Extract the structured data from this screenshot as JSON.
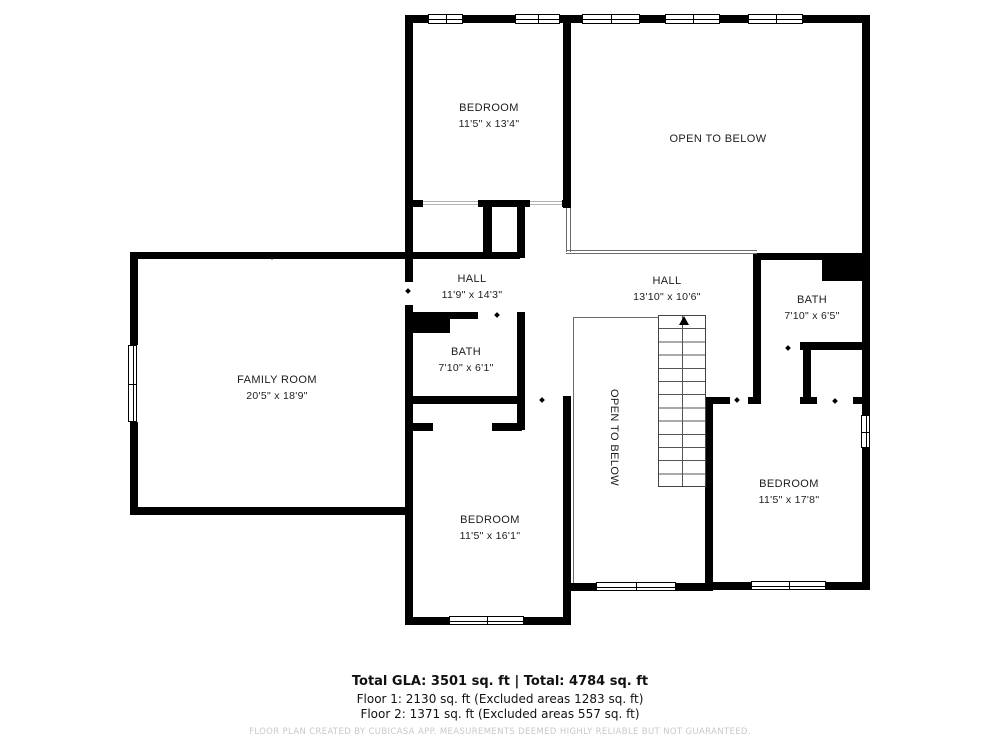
{
  "rooms": [
    {
      "id": "bedroom-top",
      "name": "BEDROOM",
      "dims": "11'5\" x 13'4\""
    },
    {
      "id": "open-below-top",
      "name": "OPEN TO BELOW",
      "dims": ""
    },
    {
      "id": "hall-left",
      "name": "HALL",
      "dims": "11'9\" x 14'3\""
    },
    {
      "id": "hall-right",
      "name": "HALL",
      "dims": "13'10\" x 10'6\""
    },
    {
      "id": "bath-right",
      "name": "BATH",
      "dims": "7'10\" x 6'5\""
    },
    {
      "id": "family-room",
      "name": "FAMILY ROOM",
      "dims": "20'5\" x 18'9\""
    },
    {
      "id": "bath-middle",
      "name": "BATH",
      "dims": "7'10\" x 6'1\""
    },
    {
      "id": "open-below-stairs",
      "name": "OPEN TO BELOW",
      "dims": ""
    },
    {
      "id": "bedroom-right",
      "name": "BEDROOM",
      "dims": "11'5\" x 17'8\""
    },
    {
      "id": "bedroom-bottom",
      "name": "BEDROOM",
      "dims": "11'5\" x 16'1\""
    }
  ],
  "summary": {
    "total": "Total GLA: 3501 sq. ft | Total: 4784 sq. ft",
    "floor1": "Floor 1: 2130 sq. ft (Excluded areas 1283 sq. ft)",
    "floor2": "Floor 2: 1371 sq. ft (Excluded areas 557 sq. ft)"
  },
  "disclaimer": "FLOOR PLAN CREATED BY CUBICASA APP. MEASUREMENTS DEEMED HIGHLY RELIABLE BUT NOT GUARANTEED.",
  "colors": {
    "wall": "#000000",
    "background": "#ffffff",
    "label": "#1c1c1c",
    "disclaimer": "#c9c9c9"
  }
}
